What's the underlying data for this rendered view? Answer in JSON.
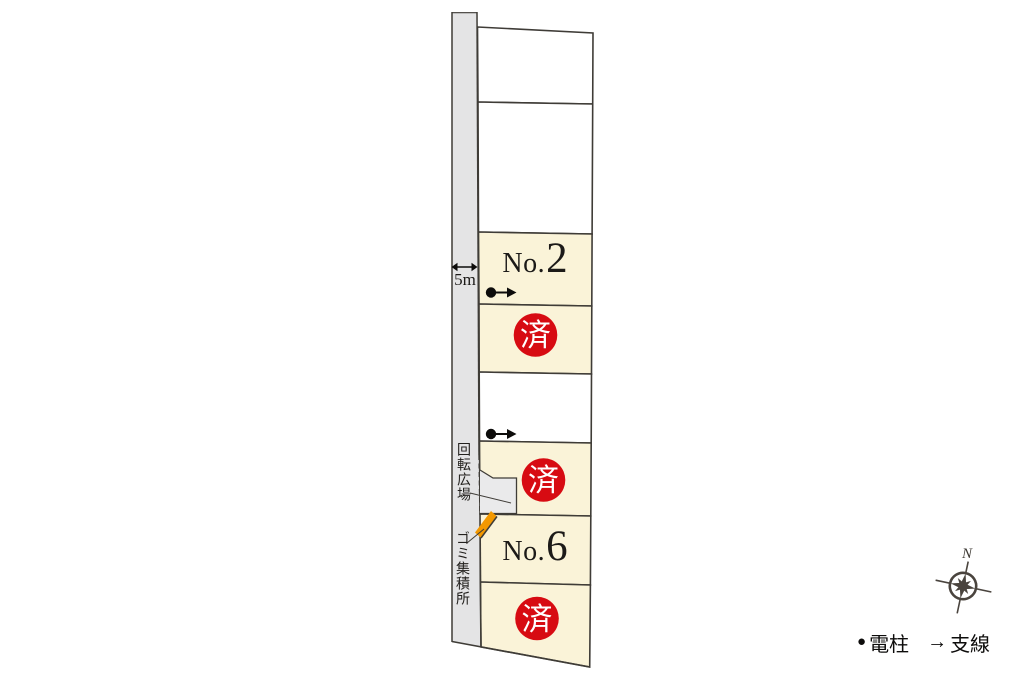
{
  "road": {
    "width_label": "5m",
    "turning_area_label": "回転広場",
    "garbage_station_label": "ゴミ集積所"
  },
  "lots": [
    {
      "id": 1,
      "label": "",
      "status": "vacant"
    },
    {
      "id": 2,
      "label": "",
      "status": "vacant"
    },
    {
      "id": 3,
      "prefix": "No.",
      "number": "2",
      "status": "for-sale"
    },
    {
      "id": 4,
      "label": "済",
      "status": "sold"
    },
    {
      "id": 5,
      "label": "",
      "status": "vacant"
    },
    {
      "id": 6,
      "label": "済",
      "status": "sold"
    },
    {
      "id": 7,
      "prefix": "No.",
      "number": "6",
      "status": "for-sale"
    },
    {
      "id": 8,
      "label": "済",
      "status": "sold"
    }
  ],
  "compass": {
    "north_label": "N"
  },
  "legend": {
    "pole_symbol": "●",
    "pole_label": "電柱",
    "wire_symbol": "→",
    "wire_label": "支線"
  },
  "colors": {
    "lot_cream": "#faf3d8",
    "lot_white": "#ffffff",
    "road_gray": "#e4e4e5",
    "plaza_gray": "#eaeaeb",
    "sold_red": "#d70b12",
    "garbage_orange": "#f39800",
    "line_dark": "#3f3c37",
    "compass_dark": "#4a443e"
  }
}
